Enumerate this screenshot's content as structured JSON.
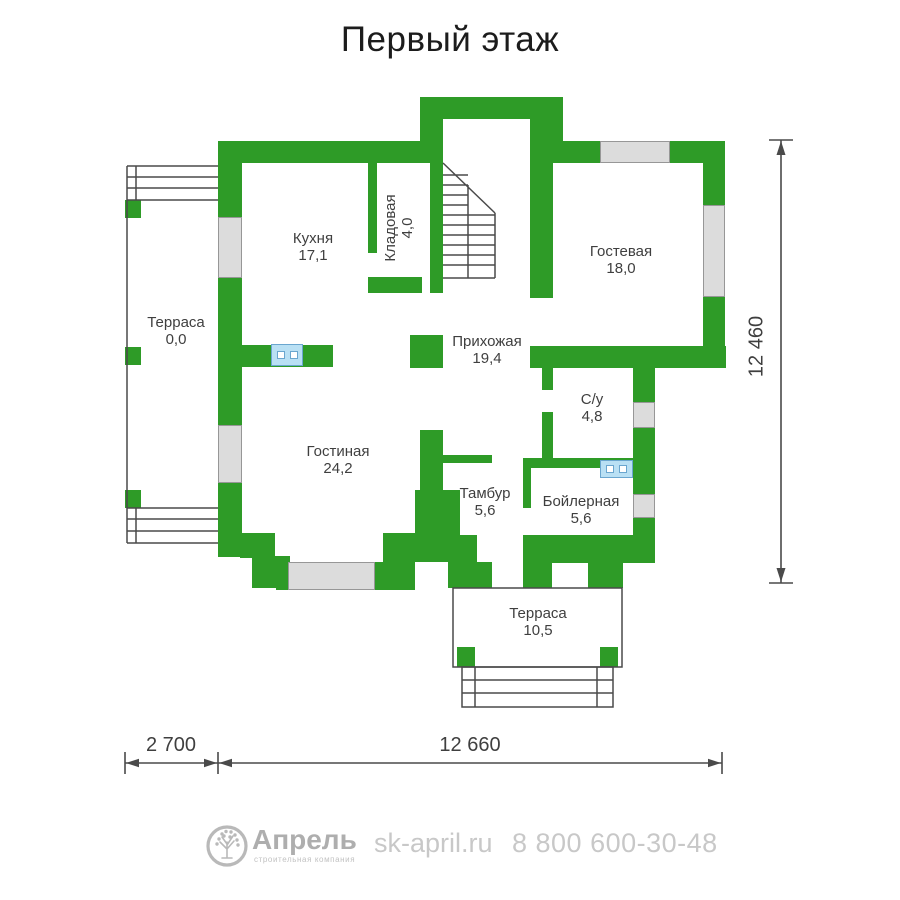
{
  "title": "Первый этаж",
  "plan": {
    "rooms": [
      {
        "name": "Кухня",
        "area": "17,1"
      },
      {
        "name": "Кладовая",
        "area": "4,0"
      },
      {
        "name": "Гостевая",
        "area": "18,0"
      },
      {
        "name": "Терраса",
        "area": "0,0"
      },
      {
        "name": "Прихожая",
        "area": "19,4"
      },
      {
        "name": "С/у",
        "area": "4,8"
      },
      {
        "name": "Гостиная",
        "area": "24,2"
      },
      {
        "name": "Тамбур",
        "area": "5,6"
      },
      {
        "name": "Бойлерная",
        "area": "5,6"
      },
      {
        "name": "Терраса",
        "area": "10,5"
      }
    ],
    "dimensions": {
      "right": "12 460",
      "bottom_left": "2 700",
      "bottom_main": "12 660"
    },
    "colors": {
      "wall": "#2e9b27",
      "window": "#dcdcdc",
      "line": "#4a4a4a",
      "symbol": "#b9e0f4"
    }
  },
  "footer": {
    "brand": "Апрель",
    "brand_sub": "строительная компания",
    "website": "sk-april.ru",
    "phone": "8 800 600-30-48"
  }
}
